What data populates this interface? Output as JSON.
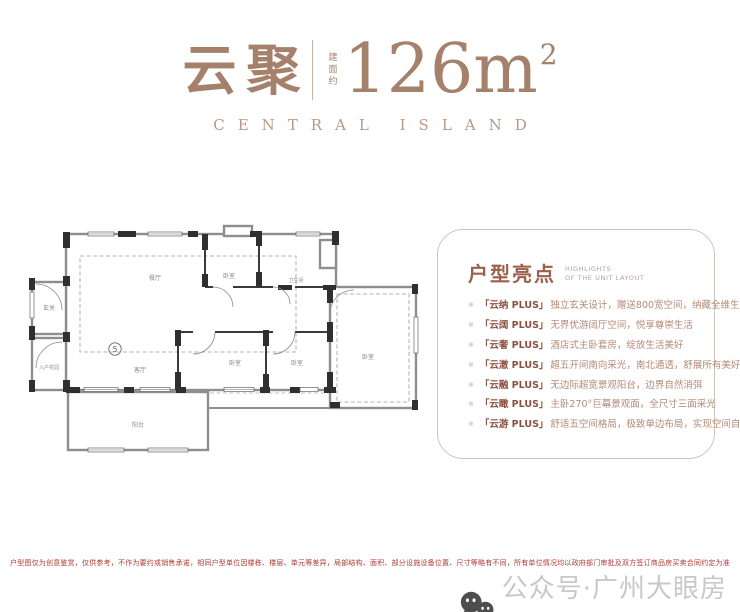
{
  "header": {
    "title_cn": "云聚",
    "area_label_vertical": "建面约",
    "area_value": "126m",
    "area_superscript": "2",
    "subtitle_en": "CENTRAL ISLAND"
  },
  "floorplan": {
    "unit_number": "5",
    "rooms": [
      {
        "id": "entry",
        "label": "玄关"
      },
      {
        "id": "entry-garden",
        "label": "入户花园"
      },
      {
        "id": "dining",
        "label": "餐厅"
      },
      {
        "id": "living",
        "label": "客厅"
      },
      {
        "id": "bedroom-top",
        "label": "卧室"
      },
      {
        "id": "bathroom",
        "label": "卫生间"
      },
      {
        "id": "bedroom-1",
        "label": "卧室"
      },
      {
        "id": "bedroom-2",
        "label": "卧室"
      },
      {
        "id": "bedroom-right",
        "label": "卧室"
      },
      {
        "id": "balcony",
        "label": "阳台"
      }
    ]
  },
  "highlights": {
    "title": "户型亮点",
    "subtitle_line1": "HIGHLIGHTS",
    "subtitle_line2": "OF THE UNIT LAYOUT",
    "bullet": "※",
    "items": [
      {
        "name": "「云纳 PLUS」",
        "desc": "独立玄关设计，赠送800宽空间，纳藏全维生活"
      },
      {
        "name": "「云阔 PLUS」",
        "desc": "无界优游阔厅空间，悦享尊崇生活"
      },
      {
        "name": "「云奢 PLUS」",
        "desc": "酒店式主卧套房，绽放生活美好"
      },
      {
        "name": "「云澈 PLUS」",
        "desc": "超五开间南向采光，南北通透，舒展所有美好"
      },
      {
        "name": "「云融 PLUS」",
        "desc": "无边际超宽景观阳台，边界自然消弭"
      },
      {
        "name": "「云瞰 PLUS」",
        "desc": "主卧270°巨幕景观面，全尺寸三面采光"
      },
      {
        "name": "「云游 PLUS」",
        "desc": "舒适五空间格局，极致单边布局，实现空间自由"
      }
    ]
  },
  "footer": {
    "disclaimer": "户型图仅为创意鉴赏，仅供参考，不作为要约或销售承诺，相同户型单位因楼栋、楼层、单元等差异，局部结构、面积、部分设施设备位置、尺寸等略有不同，所有单位情况均以政府部门审批及双方签订商品房买卖合同约定为准",
    "watermark": "公众号·广州大眼房产"
  },
  "colors": {
    "title_brown": "#a5816c",
    "subtitle_brown": "#b79a88",
    "highlight_title": "#9b5f4b",
    "item_name": "#8c503f",
    "item_desc": "#b28a77",
    "disclaimer_red": "#b23a32",
    "watermark_gray": "#c8c8c8"
  }
}
